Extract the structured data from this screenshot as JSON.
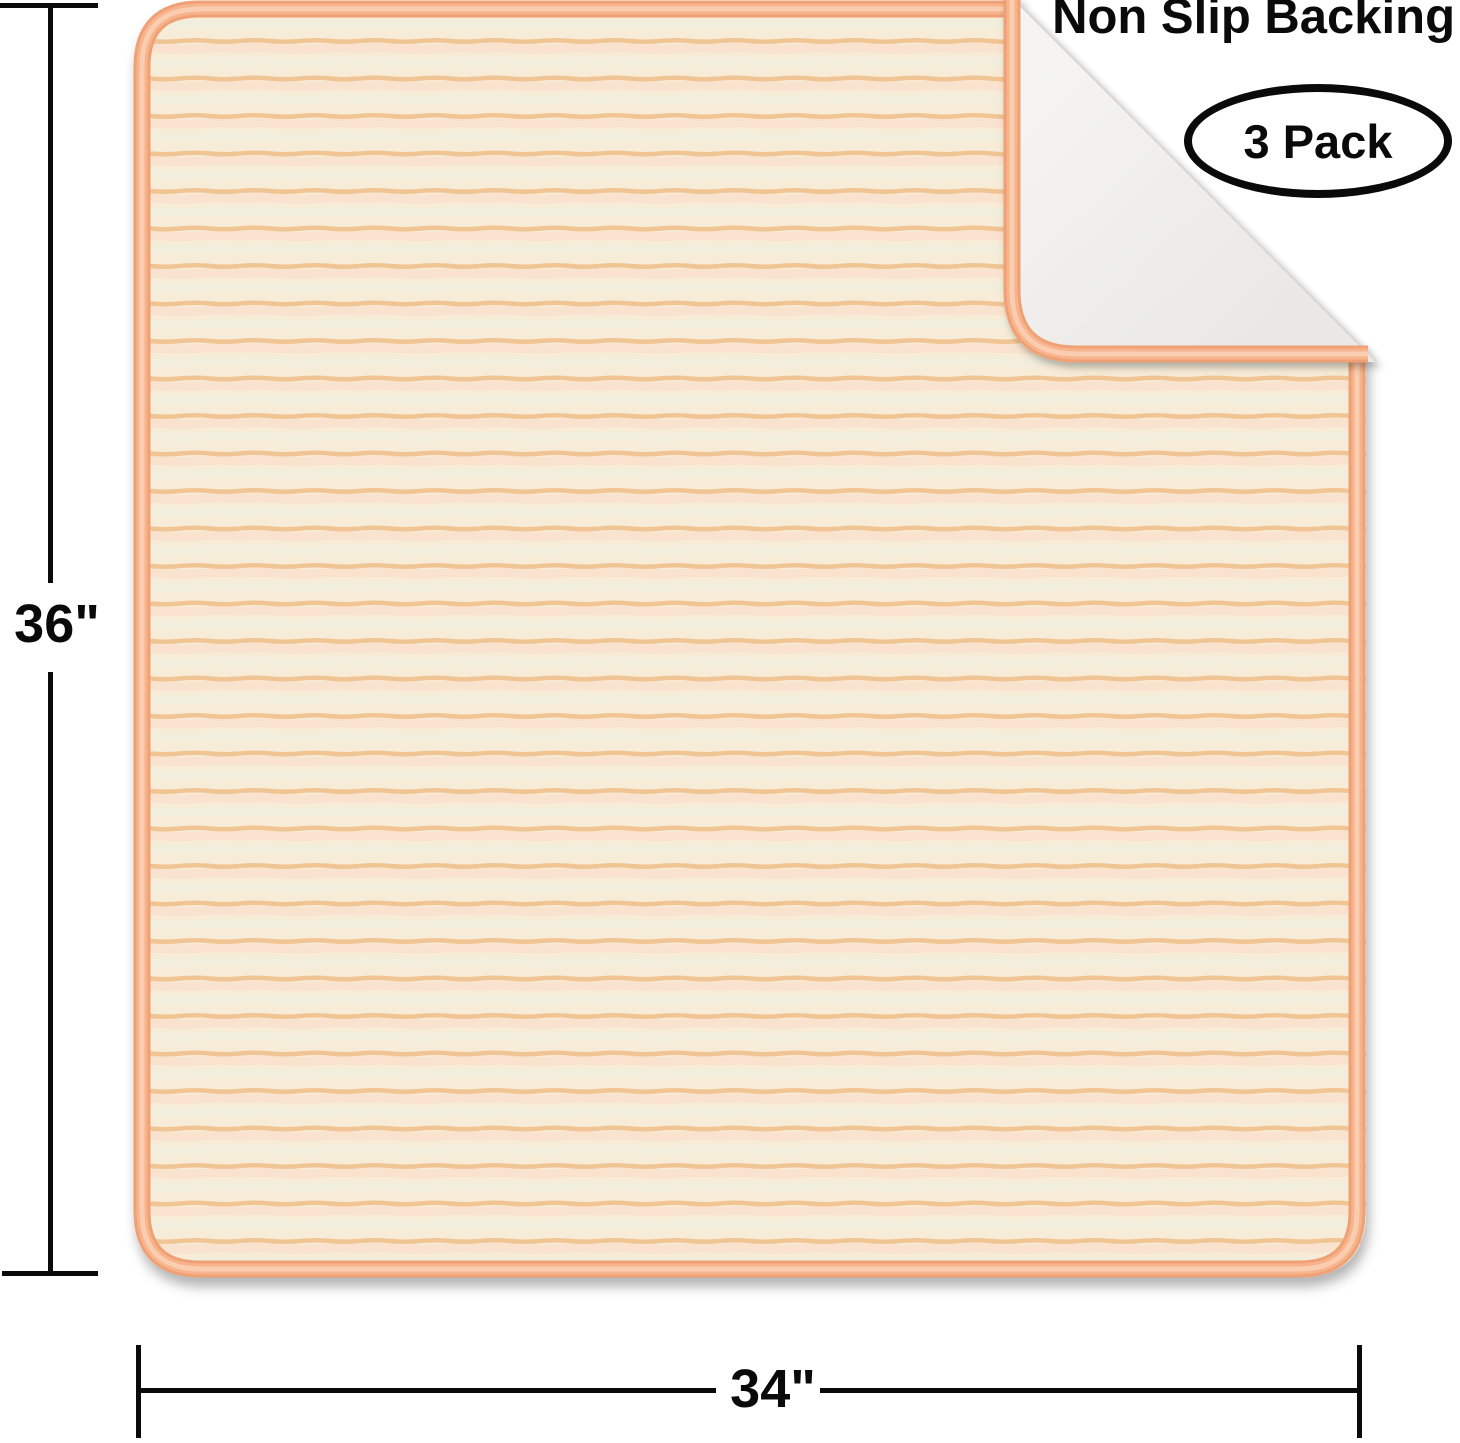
{
  "product": {
    "callout": "Non Slip Backing",
    "pack_badge": "3 Pack",
    "height_label": "36\"",
    "width_label": "34\""
  },
  "colors": {
    "fabric_base": "#F7ECD7",
    "stripe_orange": "#F1C493",
    "stripe_pink": "#FAE3CE",
    "stripe_sage": "#F1EEDD",
    "binding_outer": "#EFA074",
    "binding_mid": "#F7B48C",
    "binding_inner": "#FBCDB0",
    "backing_light": "#F5F4F2",
    "backing_dark": "#E9E8E5"
  }
}
